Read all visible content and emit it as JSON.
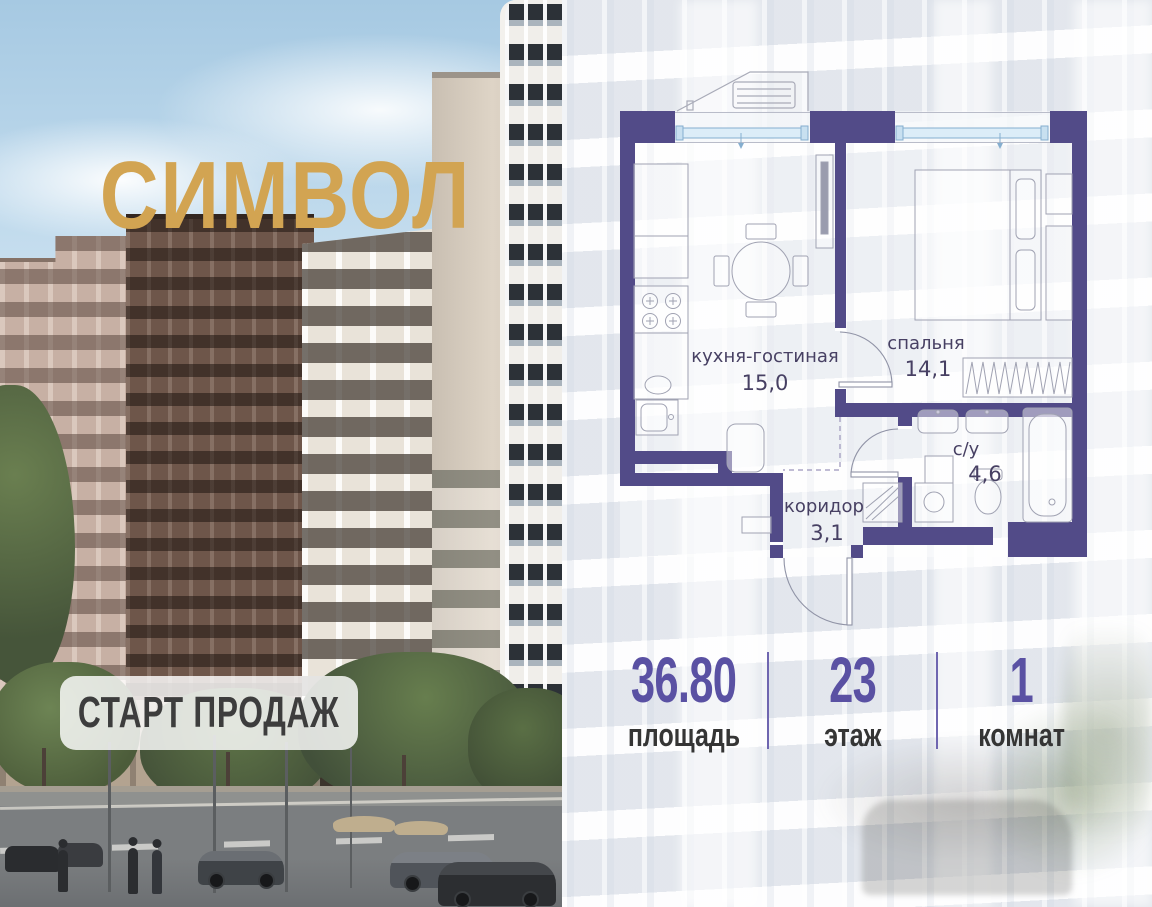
{
  "logo": {
    "text": "СИМВОЛ"
  },
  "badge": {
    "text": "СТАРТ ПРОДАЖ"
  },
  "floorplan": {
    "rooms": [
      {
        "name": "кухня-гостиная",
        "area": "15,0"
      },
      {
        "name": "спальня",
        "area": "14,1"
      },
      {
        "name": "с/у",
        "area": "4,6"
      },
      {
        "name": "коридор",
        "area": "3,1"
      }
    ],
    "icons": [
      "window-icon",
      "door-arc-icon",
      "bed-icon",
      "dining-table-icon",
      "stove-icon",
      "fridge-icon",
      "kitchen-sink-icon",
      "tv-icon",
      "boiler-icon",
      "wardrobe-icon",
      "radiator-icon",
      "bath-sink-icon",
      "washer-icon",
      "toilet-icon",
      "bathtub-icon",
      "balcony-ac-icon"
    ]
  },
  "stats": {
    "items": [
      {
        "value": "36.80",
        "label": "площадь"
      },
      {
        "value": "23",
        "label": "этаж"
      },
      {
        "value": "1",
        "label": "комнат"
      }
    ]
  },
  "colors": {
    "wall": "#524b88",
    "accent_number": "#5a51a3",
    "logo_gold": "#d2a452",
    "window_fill": "#dcedf8",
    "label_text": "#474063"
  }
}
